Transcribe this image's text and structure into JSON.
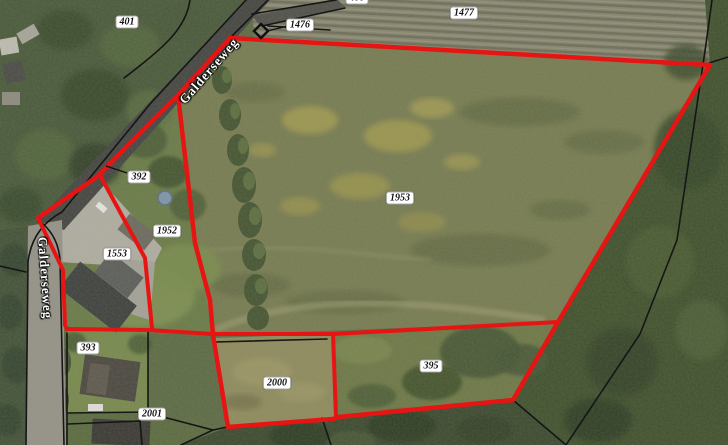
{
  "map": {
    "parcel_labels": [
      {
        "id": "401",
        "text": "401"
      },
      {
        "id": "400",
        "text": "400"
      },
      {
        "id": "1476",
        "text": "1476"
      },
      {
        "id": "1477",
        "text": "1477"
      },
      {
        "id": "392",
        "text": "392"
      },
      {
        "id": "1952",
        "text": "1952"
      },
      {
        "id": "1553",
        "text": "1553"
      },
      {
        "id": "1953",
        "text": "1953"
      },
      {
        "id": "393",
        "text": "393"
      },
      {
        "id": "2000",
        "text": "2000"
      },
      {
        "id": "395",
        "text": "395"
      },
      {
        "id": "2001",
        "text": "2001"
      }
    ],
    "road_labels": [
      {
        "id": "galderseweg-diagonal",
        "text": "Galderseweg"
      },
      {
        "id": "galderseweg-vertical",
        "text": "Galderseweg"
      }
    ],
    "markers": [
      {
        "id": "diamond-marker",
        "type": "diamond",
        "linked_label": "1476"
      }
    ],
    "leader_lines": [
      "1476",
      "392"
    ],
    "colors": {
      "boundary_red": "#e71414",
      "cadastral_line_black": "#161616",
      "label_background": "#ffffff",
      "label_text": "#111111",
      "road_label_text": "#ffffff"
    }
  }
}
